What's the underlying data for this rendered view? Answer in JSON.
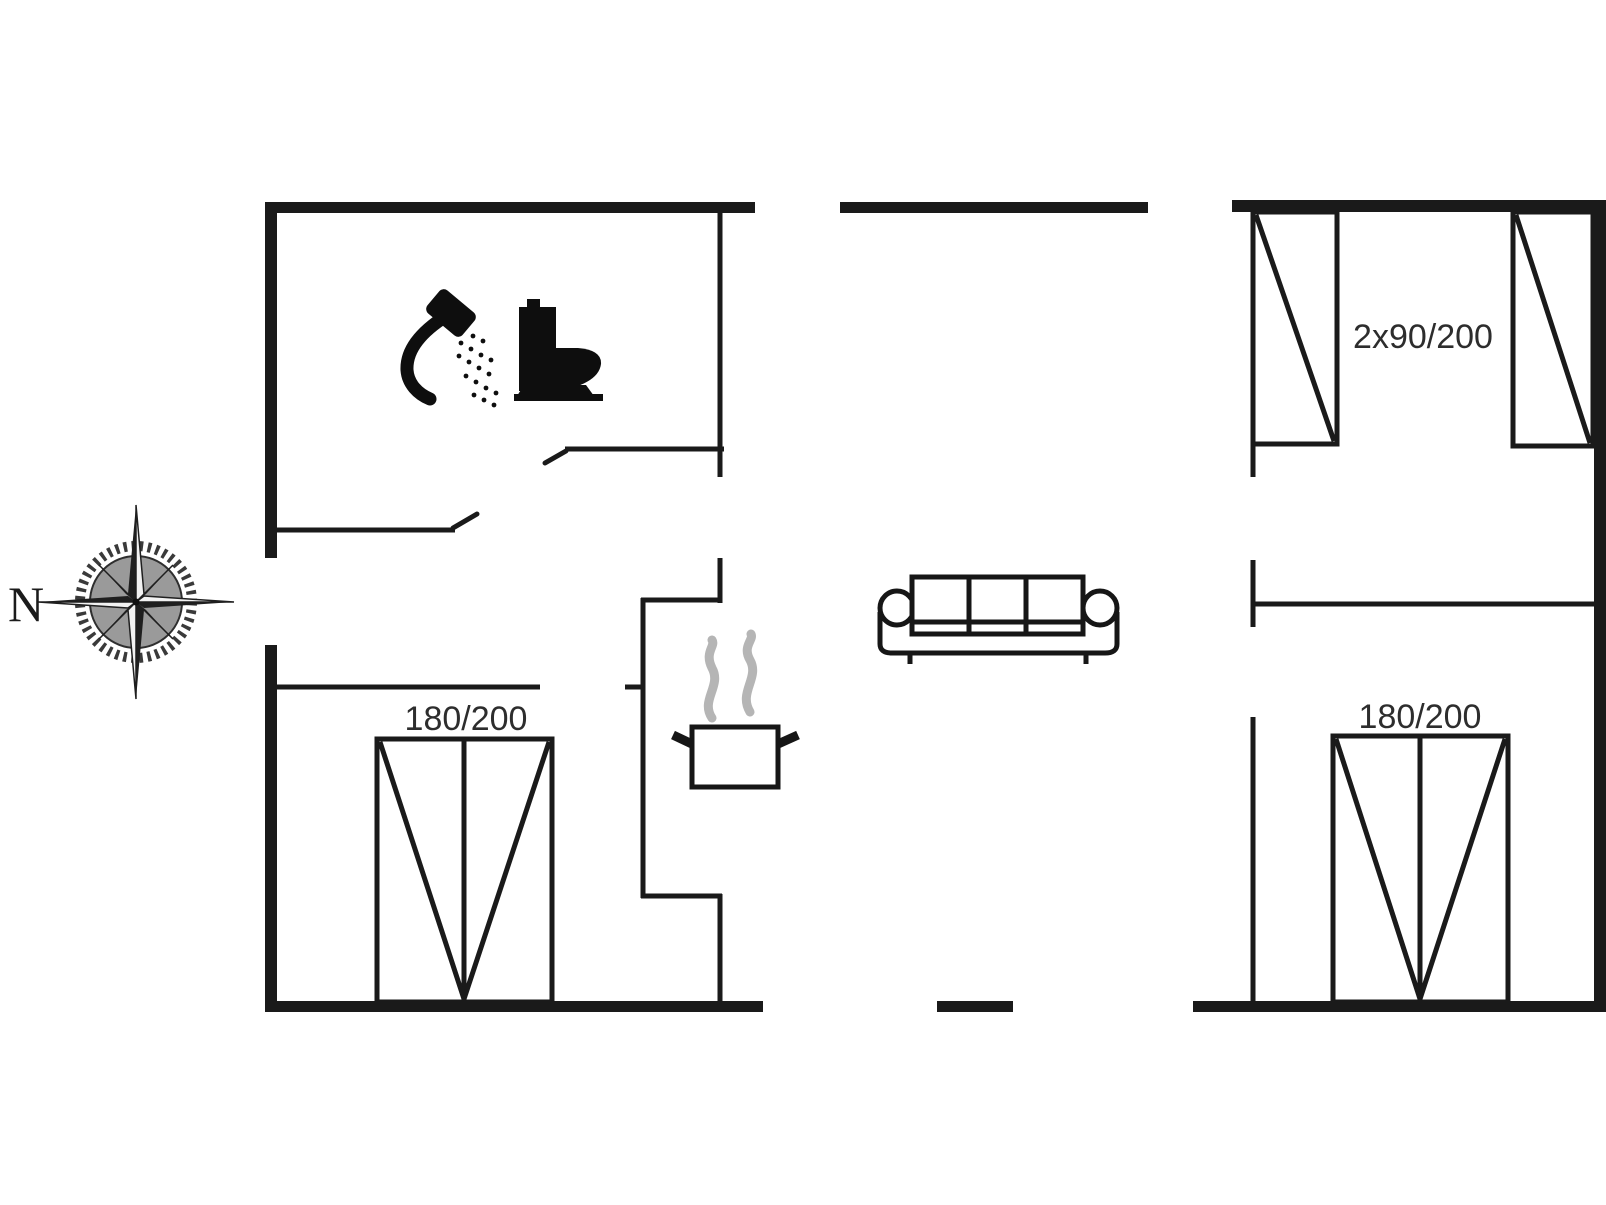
{
  "page": {
    "type": "floor-plan",
    "background": "#ffffff"
  },
  "compass": {
    "north_label": "N"
  },
  "beds": {
    "top_right_room": {
      "label": "2x90/200"
    },
    "bottom_left_room": {
      "label": "180/200"
    },
    "bottom_right_room": {
      "label": "180/200"
    }
  },
  "icons": {
    "bathroom": [
      "shower-icon",
      "toilet-icon"
    ],
    "kitchen": [
      "cooking-pot-icon",
      "steam-icon"
    ],
    "living_area": [
      "sofa-icon"
    ],
    "orientation": [
      "compass-rose-icon"
    ]
  },
  "colors": {
    "walls": "#1a1a1a",
    "labels": "#2d2d2d",
    "steam": "#b5b5b5",
    "compass_disc": "#9a9a9a",
    "background": "#ffffff"
  }
}
